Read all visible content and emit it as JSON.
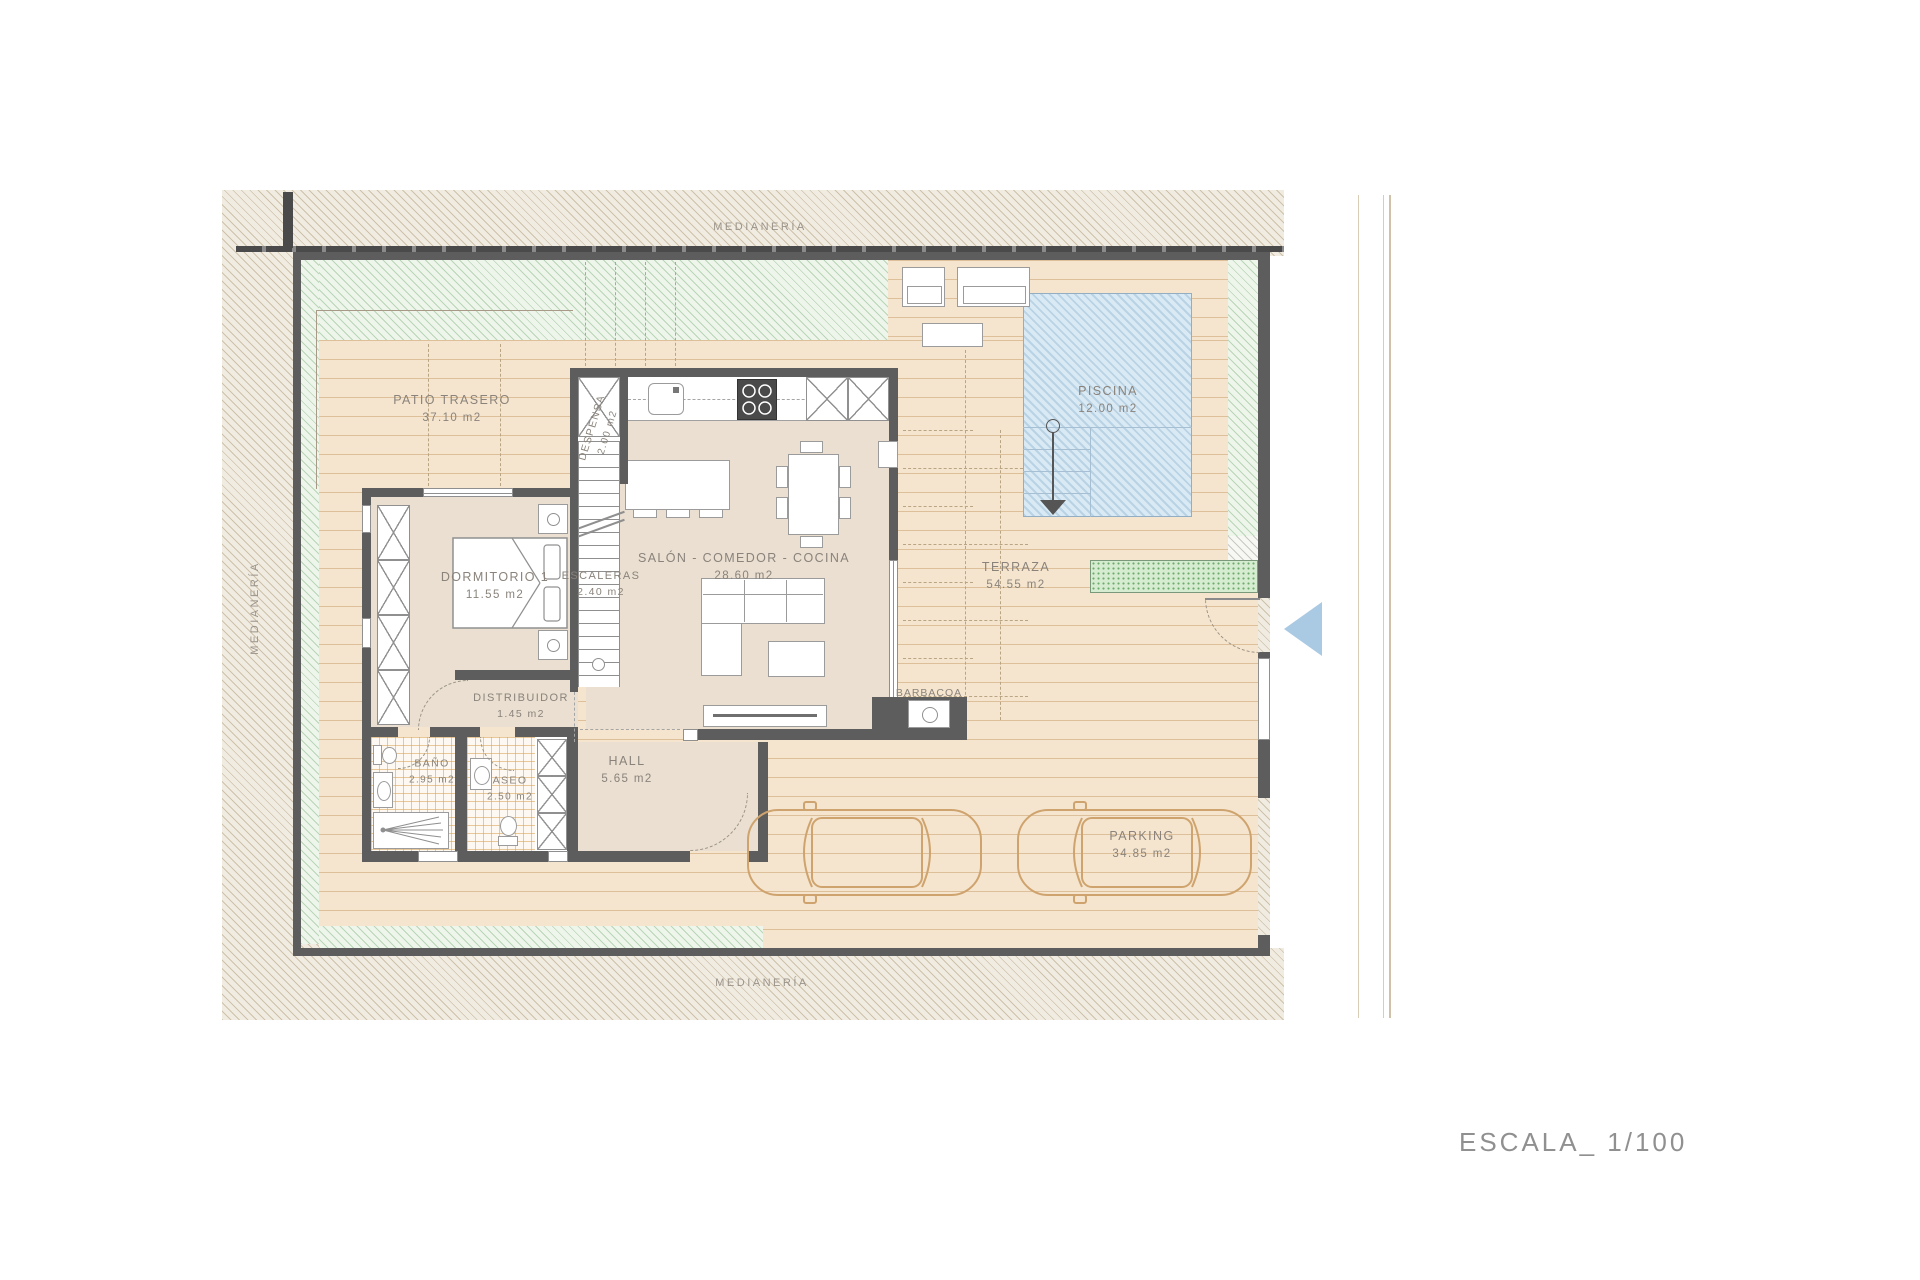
{
  "document": {
    "scale_label": "ESCALA_ 1/100"
  },
  "boundary_labels": {
    "top": "MEDIANERÍA",
    "left": "MEDIANERÍA",
    "bottom": "MEDIANERÍA"
  },
  "rooms": [
    {
      "name": "PATIO TRASERO",
      "area": "37.10 m2"
    },
    {
      "name": "DESPENSA",
      "area": "2.00 m2"
    },
    {
      "name": "DORMITORIO 1",
      "area": "11.55 m2"
    },
    {
      "name": "ESCALERAS",
      "area": "2.40 m2"
    },
    {
      "name": "SALÓN - COMEDOR - COCINA",
      "area": "28.60 m2"
    },
    {
      "name": "DISTRIBUIDOR",
      "area": "1.45 m2"
    },
    {
      "name": "BAÑO",
      "area": "2.95 m2"
    },
    {
      "name": "ASEO",
      "area": "2.50 m2"
    },
    {
      "name": "HALL",
      "area": "5.65 m2"
    },
    {
      "name": "BARBACOA",
      "area": ""
    },
    {
      "name": "TERRAZA",
      "area": "54.55 m2"
    },
    {
      "name": "PISCINA",
      "area": "12.00 m2"
    },
    {
      "name": "PARKING",
      "area": "34.85 m2"
    }
  ],
  "colors": {
    "wall": "#5d5d5d",
    "deck": "#f5e5ce",
    "deck_line": "#ddc09a",
    "green_margin": "#eef5eb",
    "pool_water": "#d9eaf5",
    "planter": "#d6ecd0",
    "boundary_hatch": "#f1ece2",
    "car_outline": "#cfa36e",
    "entrance_arrow": "#aac9e3",
    "label_text": "#8a837b"
  }
}
